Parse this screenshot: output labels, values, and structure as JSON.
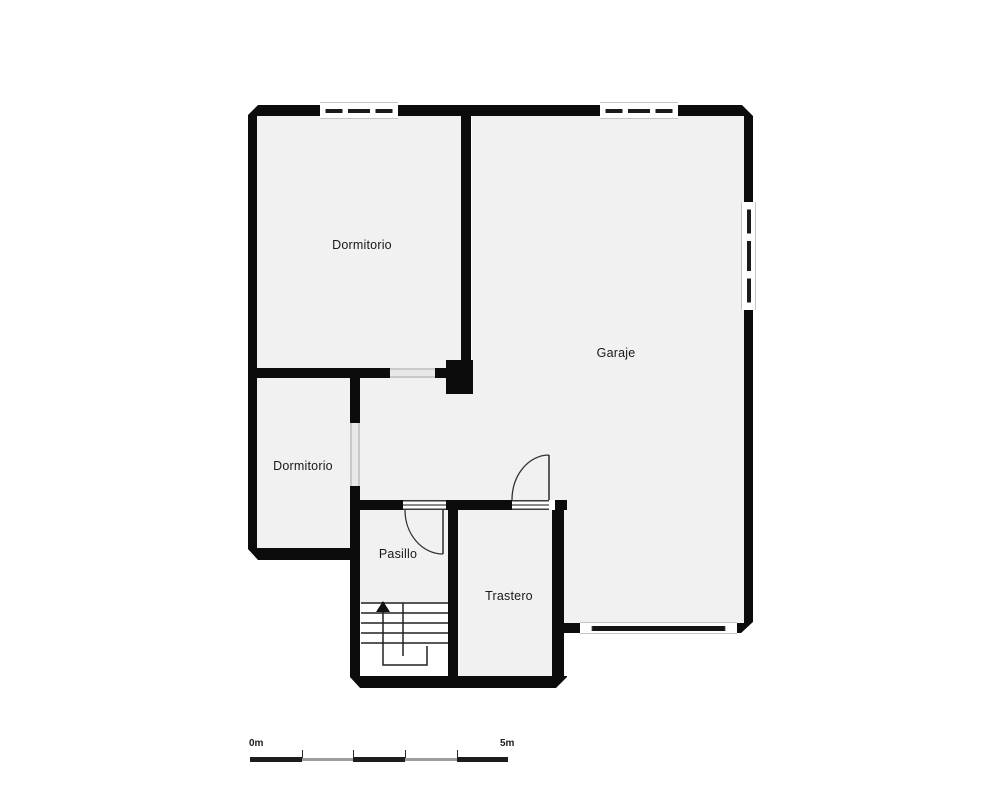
{
  "floorplan": {
    "rooms": [
      {
        "id": "dormitorio-top",
        "label": "Dormitorio"
      },
      {
        "id": "garaje",
        "label": "Garaje"
      },
      {
        "id": "dormitorio-left",
        "label": "Dormitorio"
      },
      {
        "id": "pasillo",
        "label": "Pasillo"
      },
      {
        "id": "trastero",
        "label": "Trastero"
      }
    ],
    "features": {
      "stairs": "u-return-staircase-with-up-arrow",
      "doors": [
        "pasillo-swing-door",
        "garaje-trastero-swing-door"
      ],
      "windows": [
        "top-bedroom-window",
        "garage-top-window",
        "garage-right-window",
        "garage-bottom-window"
      ]
    },
    "scale_bar": {
      "start": "0m",
      "end": "5m"
    },
    "colors": {
      "wall": "#0c0c0c",
      "floor": "#f1f1f1",
      "background": "#ffffff",
      "opening_gray": "#d6d6d6",
      "window_frame": "#c4c4c4",
      "scale_gray": "#9e9e9e"
    }
  }
}
